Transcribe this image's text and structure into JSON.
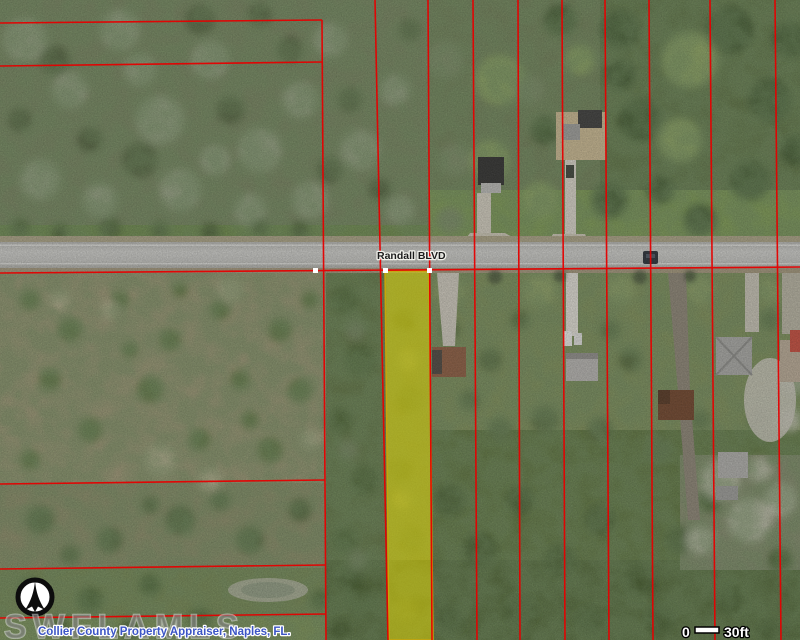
{
  "map": {
    "type": "aerial-parcel-map",
    "road_label": "Randall BLVD",
    "watermark_text": "SWFLAMLS",
    "attribution_text": "Collier County Property Appraiser, Naples, FL.",
    "scale_bar": {
      "start_label": "0",
      "end_label": "30ft"
    },
    "icons": {
      "compass": "north-arrow-icon"
    },
    "colors": {
      "parcel_line": "#e60000",
      "highlight_fill": "#e8dc00",
      "highlight_border": "#c9a40a",
      "road_surface": "#c6c6c2",
      "road_label_text": "#1c1c1c",
      "attribution_text": "#3c55c5",
      "watermark_text": "#828282",
      "scale_text": "#ffffff"
    }
  }
}
